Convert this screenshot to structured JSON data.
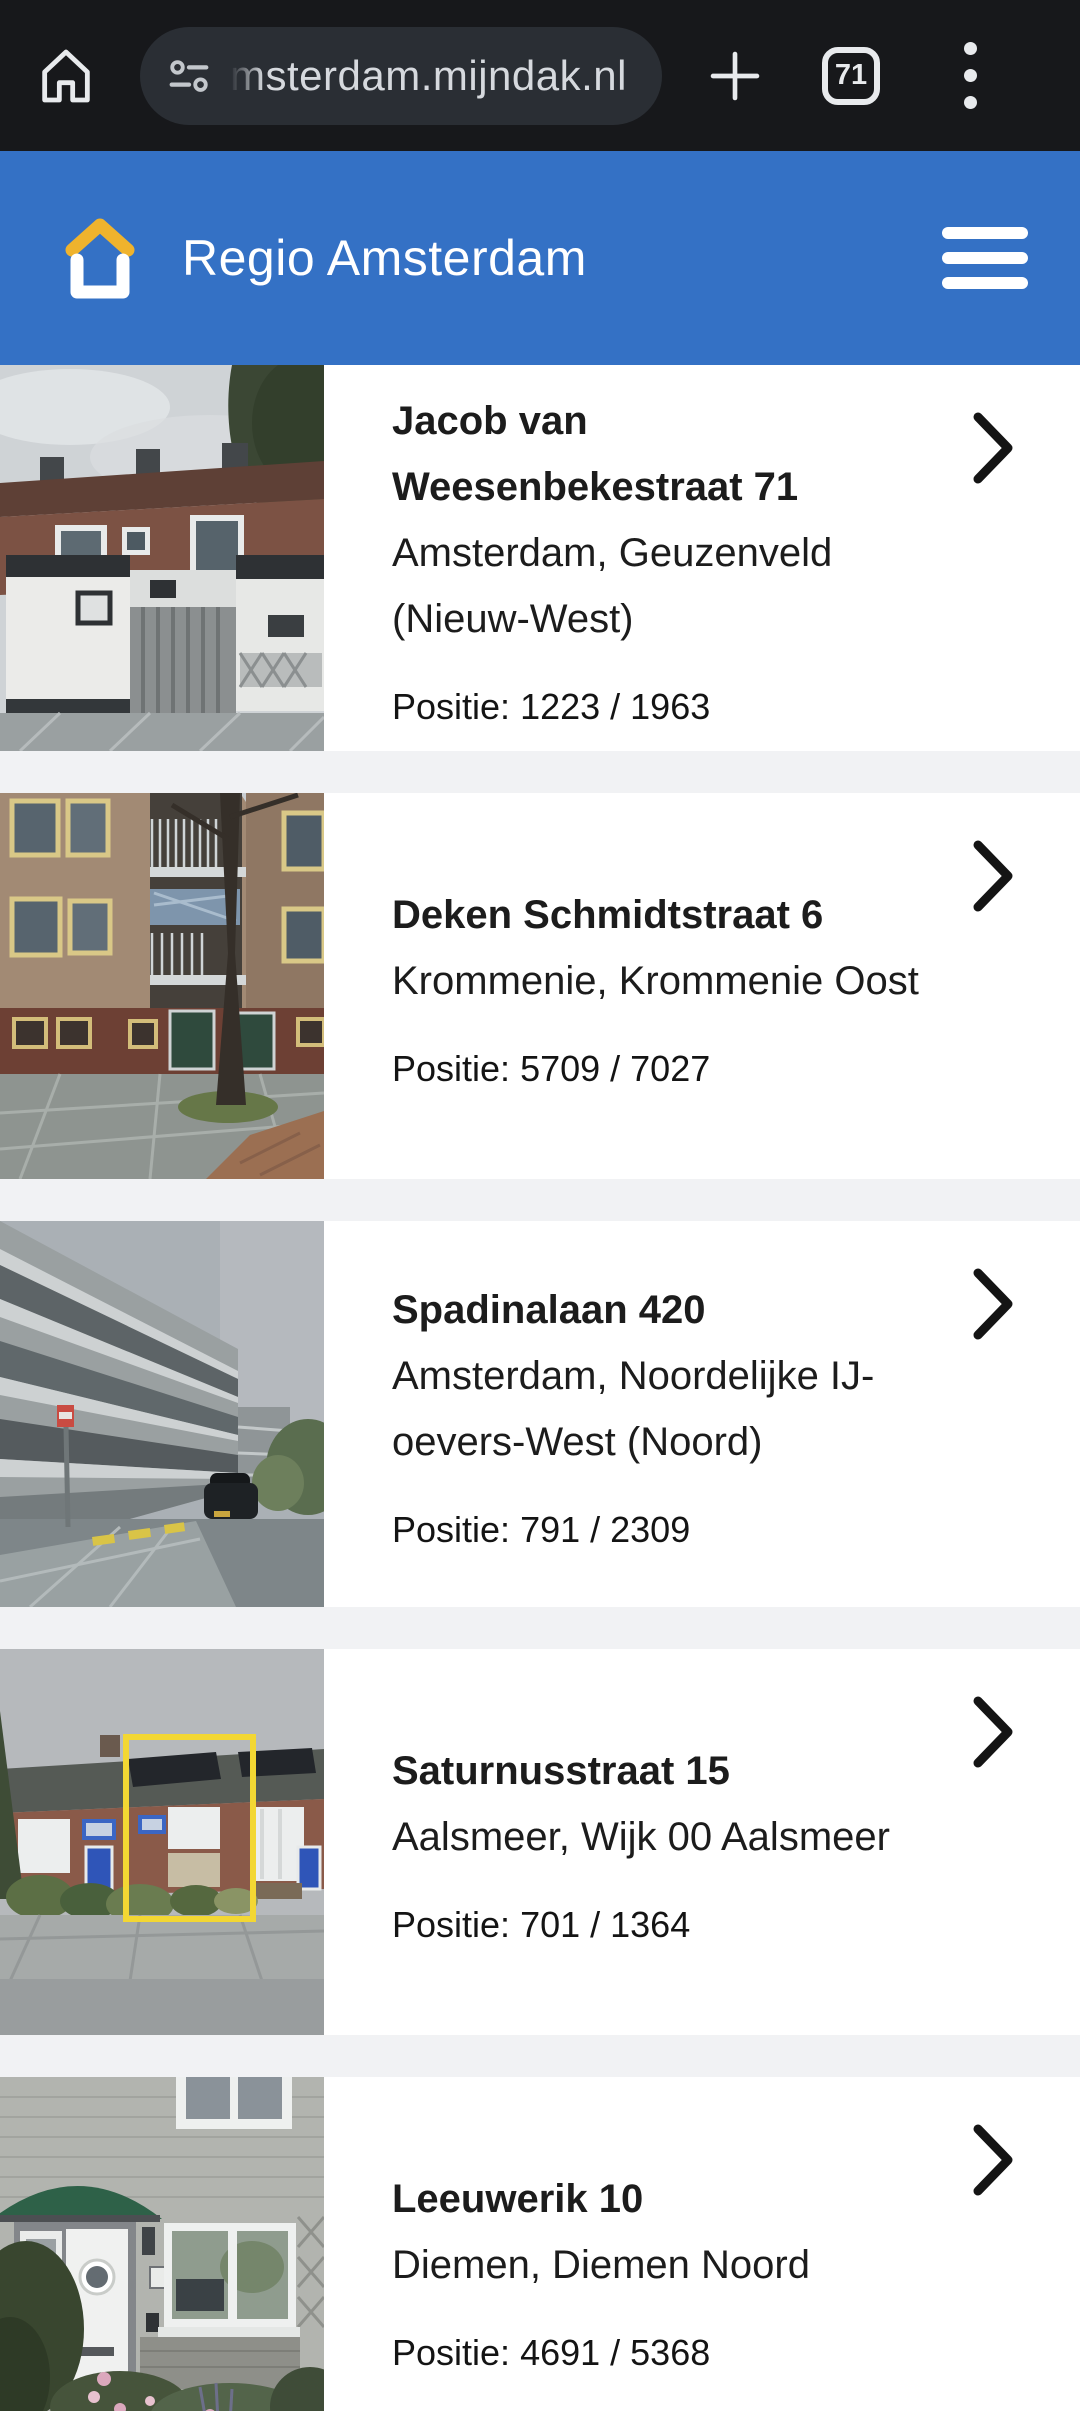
{
  "theme": {
    "toolbar_bg": "#17181b",
    "pill_bg": "#2a2e34",
    "url_text": "#d6d9de",
    "toolbar_icon": "#e8eaed",
    "header_bg": "#3471c5",
    "logo_accent": "#efb32d",
    "gap_bg": "#f1f2f4",
    "row_bg": "#ffffff",
    "text_dark": "#1c1c1c"
  },
  "browser": {
    "url": "msterdam.mijndak.nl",
    "tab_count": "71",
    "icons": [
      "home-icon",
      "tune-icon",
      "new-tab-icon",
      "tab-switcher-icon",
      "overflow-menu-icon"
    ]
  },
  "header": {
    "title": "Regio Amsterdam",
    "icons": [
      "house-logo-icon",
      "hamburger-menu-icon"
    ]
  },
  "list": {
    "items": [
      {
        "title": "Jacob van Weesenbekestraat 71",
        "location": "Amsterdam, Geuzenveld (Nieuw-West)",
        "position_label": "Positie:",
        "position_value": "1223 / 1963",
        "photo_alt": "brick terraced house with white sheds and wooden fence"
      },
      {
        "title": "Deken Schmidtstraat 6",
        "location": "Krommenie, Krommenie Oost",
        "position_label": "Positie:",
        "position_value": "5709 / 7027",
        "photo_alt": "brick apartment building with balconies and tree"
      },
      {
        "title": "Spadinalaan 420",
        "location": "Amsterdam, Noordelijke IJ-oevers-West (Noord)",
        "position_label": "Positie:",
        "position_value": "791 / 2309",
        "photo_alt": "grey apartment block along wet street with parked car"
      },
      {
        "title": "Saturnusstraat 15",
        "location": "Aalsmeer, Wijk 00 Aalsmeer",
        "position_label": "Positie:",
        "position_value": "701 / 1364",
        "photo_alt": "terraced houses with solar panels, middle house outlined in yellow"
      },
      {
        "title": "Leeuwerik 10",
        "location": "Diemen, Diemen Noord",
        "position_label": "Positie:",
        "position_value": "4691 / 5368",
        "photo_alt": "front door with green awning beside window"
      }
    ]
  }
}
